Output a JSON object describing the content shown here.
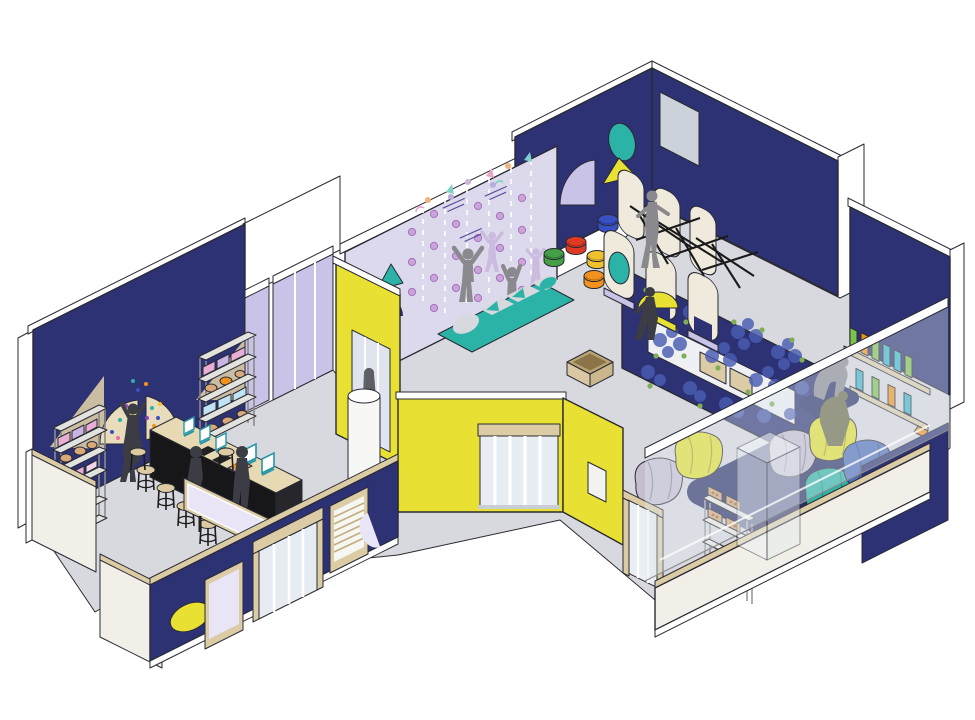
{
  "illustration": {
    "title_visible_text": "",
    "type": "isometric-interior-cutaway",
    "subject": "children's activity center floor plan illustration with three connected rooms"
  },
  "palette": {
    "white": "#ffffff",
    "outline": "#2a2a33",
    "navy": "#2c3274",
    "navy_deep": "#232a5e",
    "rug": "#272e66",
    "floor": "#d8d9de",
    "cream": "#f1efe8",
    "tan": "#dbcca6",
    "tan_dark": "#c3ae7e",
    "yellow": "#e8e133",
    "lavender_wall": "#dcd9ec",
    "lavender_panel": "#c9c3e8",
    "lavender_light": "#e9e5f6",
    "teal": "#2cb3a7",
    "gray_panel": "#ccd2da",
    "glass": "#dfe8ef",
    "black_counter": "#17171a",
    "gray_fig": "#8a8a8e",
    "dark_fig": "#3c3c44",
    "ghost_fig": "#c7b6dd",
    "hold_pink": "#cba3d6",
    "hold_stroke": "#a273bf",
    "squiggle": "#5b4f9e",
    "stool_purple": "#8e44ad",
    "stool_blue": "#3950c4",
    "stool_red": "#e03a24",
    "stool_green": "#43a047",
    "stool_gold": "#f0c12e",
    "stool_orange": "#f2921d",
    "bean_yellow": "#e3df2e",
    "bean_gray": "#c6bed0",
    "bean_teal": "#2db4a4",
    "bean_blue": "#4d6cb8",
    "flower": "#4a5db3",
    "leaf": "#7fae57",
    "book_green": "#7cc24a",
    "book_teal": "#38b6c9",
    "book_orange": "#f2921d",
    "bread": "#d9a979",
    "bread_dark": "#9a6a3a",
    "pink_item": "#e8aed6",
    "lilac_item": "#c9b4e6",
    "cyan_item": "#bfe3f2"
  },
  "scene": {
    "rooms": [
      {
        "name": "workshop-room",
        "walls": "navy",
        "objects": [
          "merch-shelf-left",
          "merch-shelf-right",
          "fan-wall-decor-with-confetti",
          "long-counter-with-tablet-stands",
          "stools-x5",
          "display-screen-panel",
          "person-reaching",
          "child-seated",
          "person-standing"
        ]
      },
      {
        "name": "play-room",
        "walls": "lavender climbing wall + navy upper walls",
        "objects": [
          "climbing-holds",
          "kid-jumping",
          "kid-reaching",
          "ghost-silhouettes",
          "wall-caption-squiggles",
          "teal-triangle",
          "navy-quarter-disc",
          "teal-ellipse",
          "lavender-fan",
          "yellow-triangle",
          "gray-wall-panel",
          "shape-play-mat",
          "stools-purple-blue-red-green-gold-orange",
          "rope-climb-structure",
          "cardboard-box"
        ]
      },
      {
        "name": "reading-lounge",
        "walls": "navy with flower window box",
        "objects": [
          "flower-clusters",
          "planter-boxes",
          "navy-rug",
          "bean-bags-yellow-gray-teal-blue",
          "book-ledges",
          "person-bending",
          "glass-partition",
          "glass-display-case",
          "snack-shelf"
        ]
      },
      {
        "name": "entry",
        "walls": "yellow",
        "objects": [
          "main-glass-door",
          "interior-glass-door",
          "side-glass-door",
          "white-column",
          "louver-panel",
          "poster-frame",
          "yellow-ellipse-decor"
        ]
      }
    ]
  }
}
